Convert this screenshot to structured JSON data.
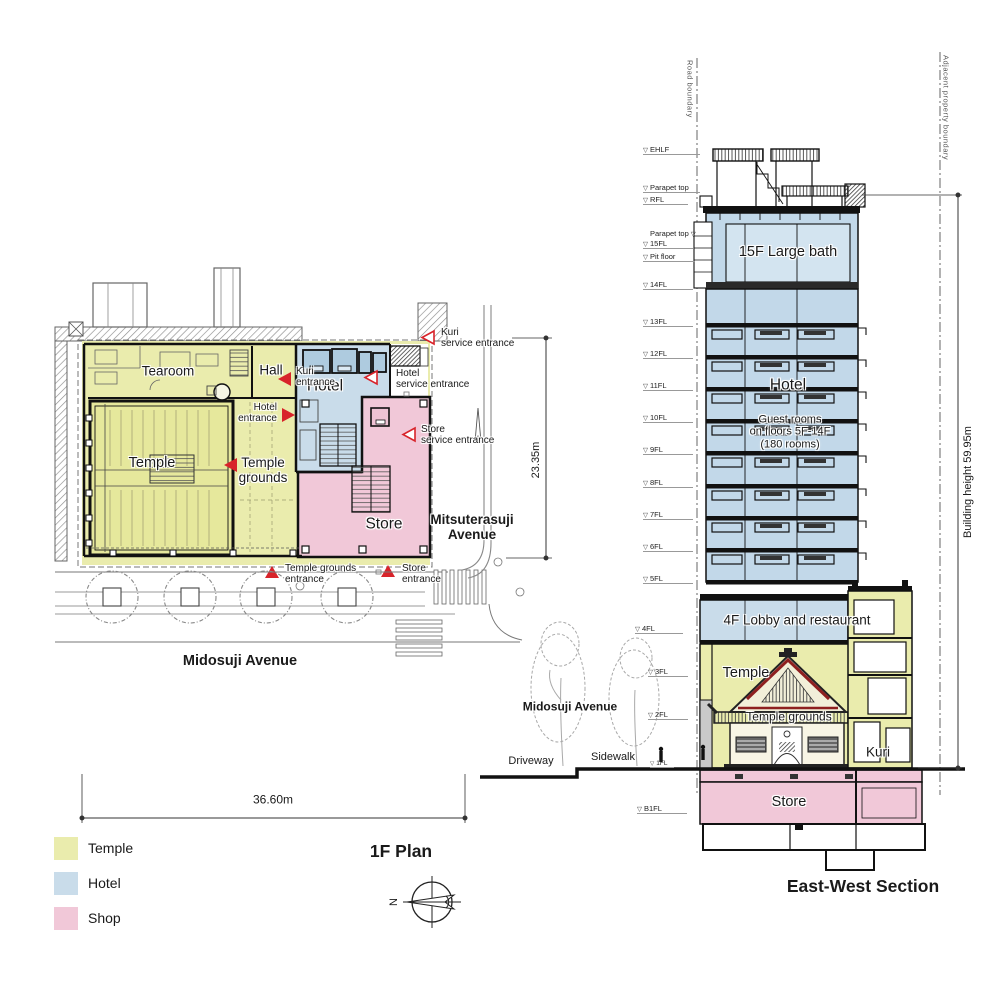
{
  "meta": {
    "plan_title": "1F Plan",
    "section_title": "East-West Section",
    "north_label": "N"
  },
  "colors": {
    "temple": "#eaecad",
    "hotel": "#c9dcea",
    "shop": "#f1c8d8",
    "accent_red": "#d8232a"
  },
  "legend": {
    "items": [
      {
        "label": "Temple",
        "color": "#eaecad"
      },
      {
        "label": "Hotel",
        "color": "#c9dcea"
      },
      {
        "label": "Shop",
        "color": "#f1c8d8"
      }
    ]
  },
  "plan": {
    "rooms": {
      "tearoom": "Tearoom",
      "hall": "Hall",
      "temple": "Temple",
      "temple_grounds_1": "Temple",
      "temple_grounds_2": "grounds",
      "hotel": "Hotel",
      "store": "Store"
    },
    "entrances": {
      "kuri_1": "Kuri",
      "kuri_2": "entrance",
      "hotel_1": "Hotel",
      "hotel_2": "entrance",
      "kuri_service_1": "Kuri",
      "kuri_service_2": "service entrance",
      "hotel_service_1": "Hotel",
      "hotel_service_2": "service entrance",
      "store_service_1": "Store",
      "store_service_2": "service entrance",
      "temple_grounds_1": "Temple grounds",
      "temple_grounds_2": "entrance",
      "store_1": "Store",
      "store_2": "entrance"
    },
    "streets": {
      "south": "Midosuji Avenue",
      "east_1": "Mitsuterasuji",
      "east_2": "Avenue"
    },
    "dimensions": {
      "width": "36.60m",
      "depth": "23.35m"
    }
  },
  "section": {
    "labels": {
      "large_bath": "15F Large bath",
      "hotel": "Hotel",
      "guest_rooms_1": "Guest rooms",
      "guest_rooms_2": "on floors 5F-14F",
      "guest_rooms_3": "(180 rooms)",
      "lobby": "4F Lobby and restaurant",
      "temple": "Temple",
      "temple_grounds": "Temple grounds",
      "kuri": "Kuri",
      "store": "Store"
    },
    "levels": [
      {
        "label": "EHLF"
      },
      {
        "label": "Parapet top"
      },
      {
        "label": "RFL"
      },
      {
        "label": "Parapet top"
      },
      {
        "label": "15FL"
      },
      {
        "label": "Pit floor"
      },
      {
        "label": "14FL"
      },
      {
        "label": "13FL"
      },
      {
        "label": "12FL"
      },
      {
        "label": "11FL"
      },
      {
        "label": "10FL"
      },
      {
        "label": "9FL"
      },
      {
        "label": "8FL"
      },
      {
        "label": "7FL"
      },
      {
        "label": "6FL"
      },
      {
        "label": "5FL"
      },
      {
        "label": "4FL"
      },
      {
        "label": "3FL"
      },
      {
        "label": "2FL"
      },
      {
        "label": "1FL"
      },
      {
        "label": "B1FL"
      }
    ],
    "boundaries": {
      "road": "Road boundary",
      "adjacent": "Adjacent property boundary"
    },
    "building_height": "Building height  59.95m",
    "street": {
      "name": "Midosuji Avenue",
      "driveway": "Driveway",
      "sidewalk": "Sidewalk"
    }
  }
}
